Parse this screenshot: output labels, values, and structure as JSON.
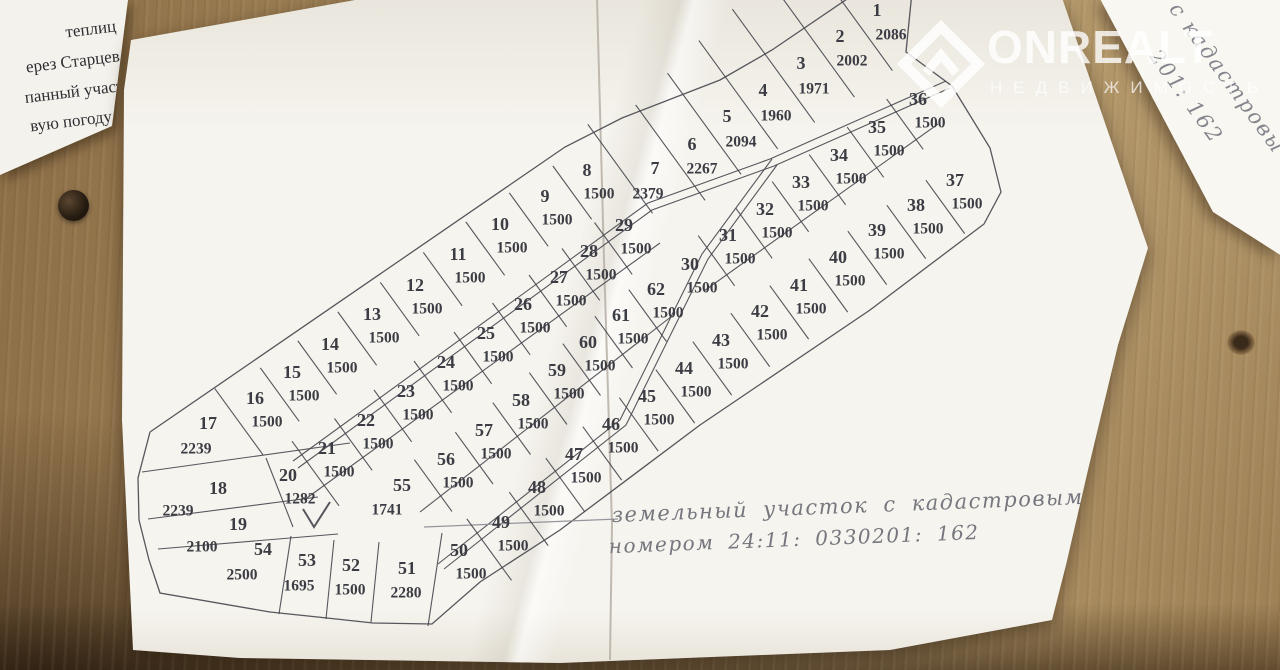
{
  "watermark": {
    "brand": "ONREALT",
    "subtitle": "НЕДВИЖИМОСТЬ"
  },
  "left_paper": {
    "lines": [
      "теплиц",
      "ерез Старцев",
      "панный участ",
      "вую погоду м"
    ]
  },
  "corner_paper": {
    "lines": [
      "с кадастровы",
      "201: 162"
    ]
  },
  "note": {
    "line1": "земельный участок с кадастровым",
    "line2": "номером  24:11: 0330201: 162"
  },
  "plan": {
    "ink": "#45454d",
    "pencil": "#8b8b93",
    "bands": [
      {
        "name": "row-north",
        "dividers": true,
        "t1": 36,
        "t2": 30,
        "plots": [
          {
            "n": 17,
            "area": 2239,
            "x": 208,
            "y": 425,
            "ax": 196,
            "ay": 450,
            "t1": 42,
            "t2": 40
          },
          {
            "n": 16,
            "area": 1500,
            "x": 255,
            "y": 400
          },
          {
            "n": 15,
            "area": 1500,
            "x": 292,
            "y": 374
          },
          {
            "n": 14,
            "area": 1500,
            "x": 330,
            "y": 346
          },
          {
            "n": 13,
            "area": 1500,
            "x": 372,
            "y": 316
          },
          {
            "n": 12,
            "area": 1500,
            "x": 415,
            "y": 287
          },
          {
            "n": 11,
            "area": 1500,
            "x": 458,
            "y": 256
          },
          {
            "n": 10,
            "area": 1500,
            "x": 500,
            "y": 226
          },
          {
            "n": 9,
            "area": 1500,
            "x": 545,
            "y": 198
          },
          {
            "n": 8,
            "area": 1500,
            "x": 587,
            "y": 172
          },
          {
            "n": 7,
            "area": 2379,
            "x": 655,
            "y": 170,
            "ax": 648,
            "ay": 195,
            "t1": 70,
            "t2": 40
          },
          {
            "n": 6,
            "area": 2267,
            "x": 692,
            "y": 146,
            "ax": 702,
            "ay": 170,
            "t1": 78,
            "t2": 40
          },
          {
            "n": 5,
            "area": 2094,
            "x": 727,
            "y": 118,
            "ax": 741,
            "ay": 143,
            "t1": 85,
            "t2": 40
          },
          {
            "n": 4,
            "area": 1960,
            "x": 763,
            "y": 92,
            "ax": 776,
            "ay": 117,
            "t1": 92,
            "t2": 42
          },
          {
            "n": 3,
            "area": 1971,
            "x": 801,
            "y": 65,
            "ax": 814,
            "ay": 90,
            "t1": 98,
            "t2": 42
          },
          {
            "n": 2,
            "area": 2002,
            "x": 840,
            "y": 38,
            "ax": 852,
            "ay": 62,
            "t1": 105,
            "t2": 44
          },
          {
            "n": 1,
            "area": 2086,
            "x": 877,
            "y": 12,
            "ax": 891,
            "ay": 36,
            "t1": 112,
            "t2": 44
          }
        ]
      },
      {
        "name": "row-mid-north",
        "dividers": true,
        "t1": 34,
        "t2": 30,
        "plots": [
          {
            "n": 20,
            "area": 1282,
            "x": 288,
            "y": 477,
            "t1": 40,
            "t2": 40
          },
          {
            "n": 21,
            "area": 1500,
            "x": 327,
            "y": 450
          },
          {
            "n": 22,
            "area": 1500,
            "x": 366,
            "y": 422
          },
          {
            "n": 23,
            "area": 1500,
            "x": 406,
            "y": 393
          },
          {
            "n": 24,
            "area": 1500,
            "x": 446,
            "y": 364
          },
          {
            "n": 25,
            "area": 1500,
            "x": 486,
            "y": 335
          },
          {
            "n": 26,
            "area": 1500,
            "x": 523,
            "y": 306
          },
          {
            "n": 27,
            "area": 1500,
            "x": 559,
            "y": 279
          },
          {
            "n": 28,
            "area": 1500,
            "x": 589,
            "y": 253
          },
          {
            "n": 29,
            "area": 1500,
            "x": 624,
            "y": 227
          }
        ]
      },
      {
        "name": "row-mid-south",
        "dividers": true,
        "t1": 30,
        "t2": 34,
        "plots": [
          {
            "n": 55,
            "area": 1741,
            "x": 402,
            "y": 487,
            "ax": 387,
            "ay": 511
          },
          {
            "n": 56,
            "area": 1500,
            "x": 446,
            "y": 461
          },
          {
            "n": 57,
            "area": 1500,
            "x": 484,
            "y": 432
          },
          {
            "n": 58,
            "area": 1500,
            "x": 521,
            "y": 402
          },
          {
            "n": 59,
            "area": 1500,
            "x": 557,
            "y": 372
          },
          {
            "n": 60,
            "area": 1500,
            "x": 588,
            "y": 344
          },
          {
            "n": 61,
            "area": 1500,
            "x": 621,
            "y": 317
          },
          {
            "n": 62,
            "area": 1500,
            "x": 656,
            "y": 291
          }
        ]
      },
      {
        "name": "row-se-north",
        "dividers": true,
        "t1": 32,
        "t2": 30,
        "plots": [
          {
            "n": 30,
            "area": 1500,
            "x": 690,
            "y": 266
          },
          {
            "n": 31,
            "area": 1500,
            "x": 728,
            "y": 237
          },
          {
            "n": 32,
            "area": 1500,
            "x": 765,
            "y": 211
          },
          {
            "n": 33,
            "area": 1500,
            "x": 801,
            "y": 184
          },
          {
            "n": 34,
            "area": 1500,
            "x": 839,
            "y": 157
          },
          {
            "n": 35,
            "area": 1500,
            "x": 877,
            "y": 129
          },
          {
            "n": 36,
            "area": 1500,
            "x": 918,
            "y": 101
          }
        ]
      },
      {
        "name": "row-se-south",
        "dividers": true,
        "t1": 30,
        "t2": 36,
        "plots": [
          {
            "n": 37,
            "area": 1500,
            "x": 955,
            "y": 182
          },
          {
            "n": 38,
            "area": 1500,
            "x": 916,
            "y": 207
          },
          {
            "n": 39,
            "area": 1500,
            "x": 877,
            "y": 232
          },
          {
            "n": 40,
            "area": 1500,
            "x": 838,
            "y": 259
          },
          {
            "n": 41,
            "area": 1500,
            "x": 799,
            "y": 287
          },
          {
            "n": 42,
            "area": 1500,
            "x": 760,
            "y": 313
          },
          {
            "n": 43,
            "area": 1500,
            "x": 721,
            "y": 342
          },
          {
            "n": 44,
            "area": 1500,
            "x": 684,
            "y": 370
          },
          {
            "n": 45,
            "area": 1500,
            "x": 647,
            "y": 398
          },
          {
            "n": 46,
            "area": 1500,
            "x": 611,
            "y": 426
          },
          {
            "n": 47,
            "area": 1500,
            "x": 574,
            "y": 456
          },
          {
            "n": 48,
            "area": 1500,
            "x": 537,
            "y": 489
          },
          {
            "n": 49,
            "area": 1500,
            "x": 501,
            "y": 524
          },
          {
            "n": 50,
            "area": 1500,
            "x": 459,
            "y": 552,
            "t1": 36,
            "t2": 40
          }
        ]
      },
      {
        "name": "row-bottom",
        "dividers": false,
        "plots": [
          {
            "n": 51,
            "area": 2280,
            "x": 407,
            "y": 570,
            "ax": 406,
            "ay": 594
          },
          {
            "n": 52,
            "area": 1500,
            "x": 351,
            "y": 567,
            "ax": 350,
            "ay": 591
          },
          {
            "n": 53,
            "area": 1695,
            "x": 307,
            "y": 562,
            "ax": 299,
            "ay": 587
          },
          {
            "n": 54,
            "area": 2500,
            "x": 263,
            "y": 551,
            "ax": 242,
            "ay": 576
          }
        ]
      },
      {
        "name": "west-plots",
        "dividers": false,
        "plots": [
          {
            "n": 18,
            "area": 2239,
            "x": 218,
            "y": 490,
            "ax": 178,
            "ay": 512
          },
          {
            "n": 19,
            "area": 2100,
            "x": 238,
            "y": 526,
            "ax": 202,
            "ay": 548
          }
        ]
      }
    ]
  }
}
